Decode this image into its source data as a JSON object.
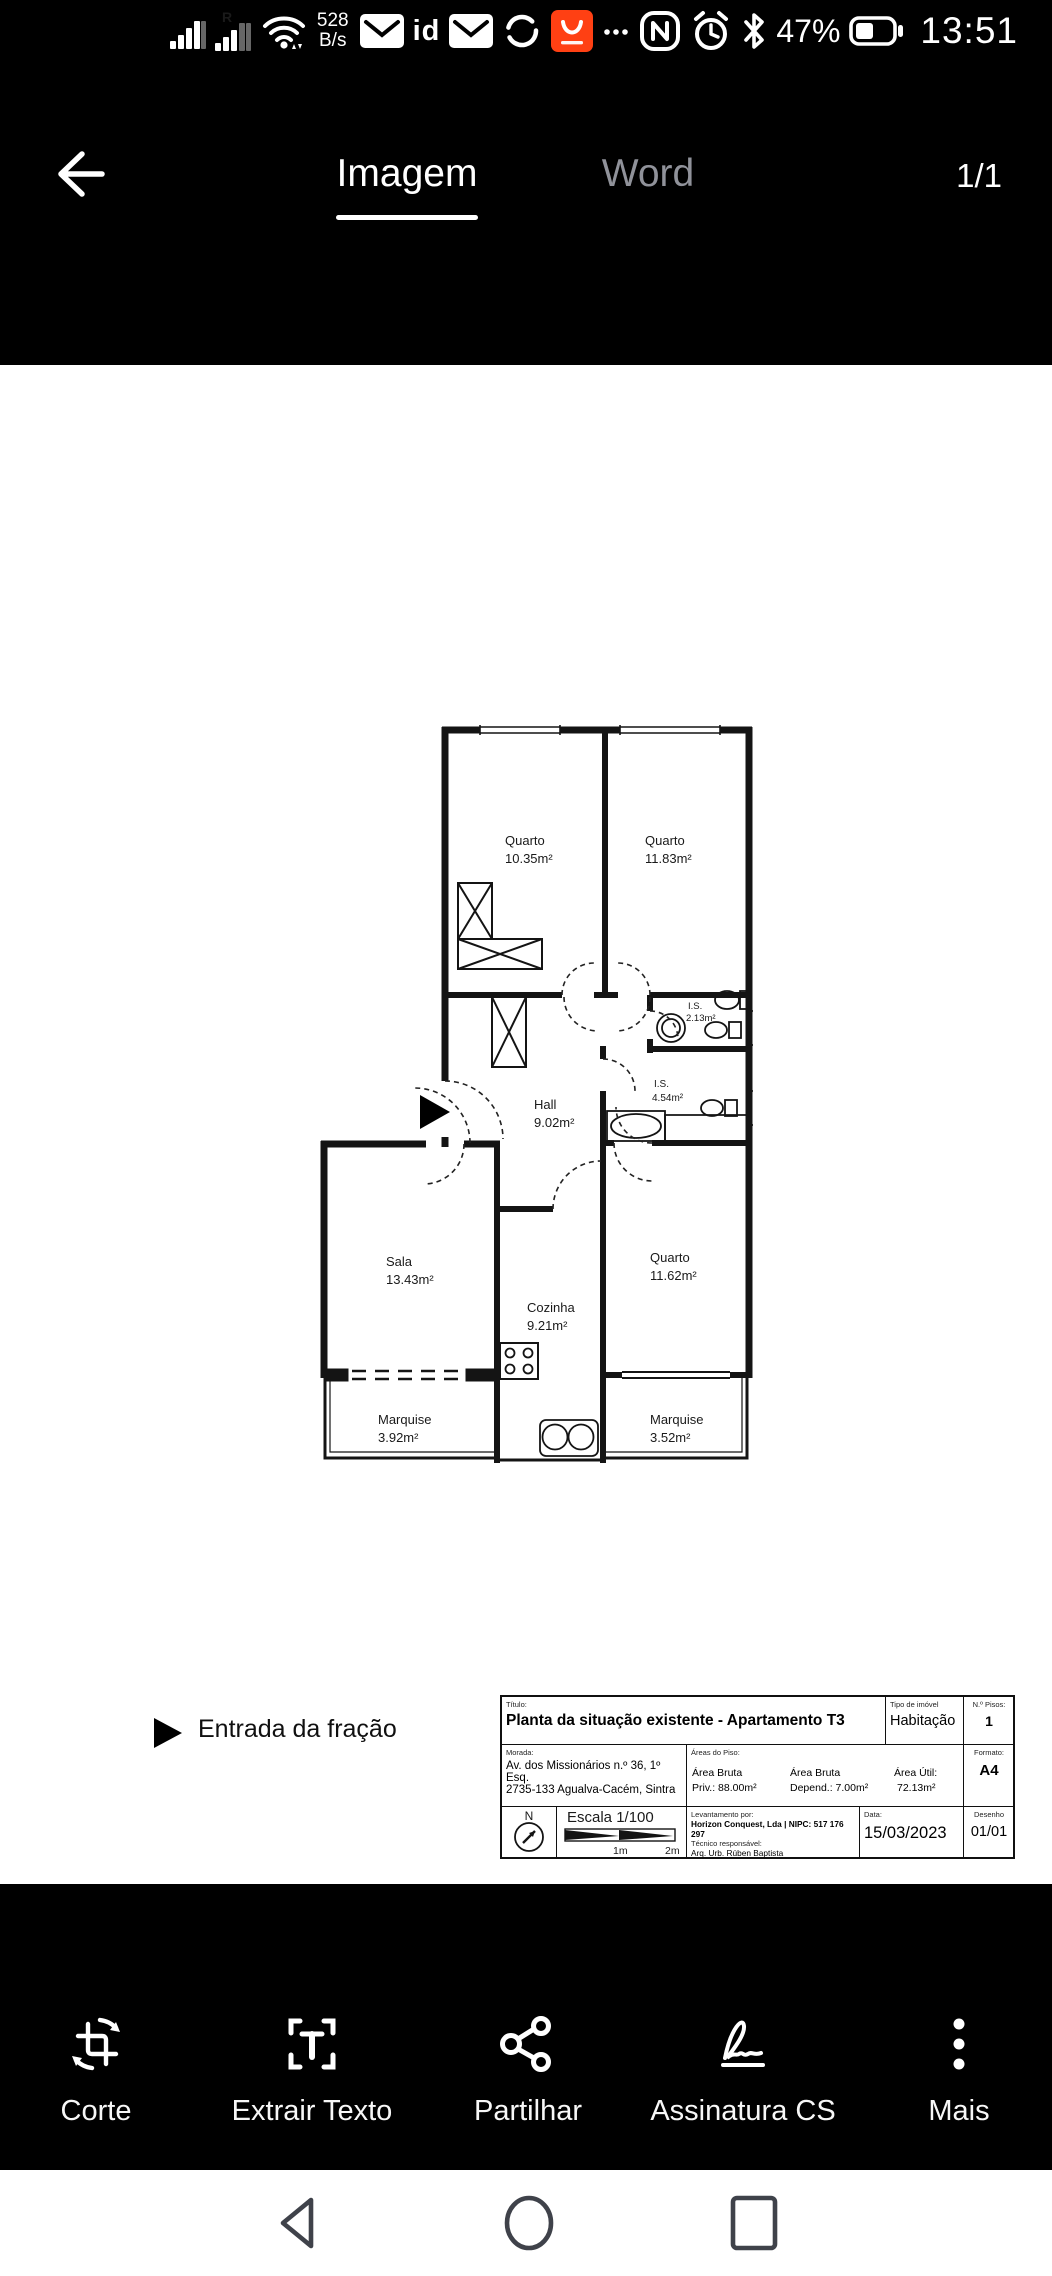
{
  "status_bar": {
    "sim_r_label": "R",
    "net_speed_value": "528",
    "net_speed_unit": "B/s",
    "id_label": "id",
    "battery_percent": "47%",
    "time": "13:51",
    "icons": [
      "signal-icon",
      "signal-r-icon",
      "wifi-icon",
      "mail-icon",
      "id-icon",
      "mail-icon",
      "sync-icon",
      "aliexpress-icon",
      "overflow-dots-icon",
      "nfc-icon",
      "alarm-icon",
      "bluetooth-icon",
      "battery-icon"
    ],
    "accent_red": "#ff4013"
  },
  "header": {
    "tabs": [
      {
        "label": "Imagem",
        "active": true
      },
      {
        "label": "Word",
        "active": false
      }
    ],
    "page_indicator": "1/1"
  },
  "floor_plan": {
    "rooms": [
      {
        "name": "Quarto",
        "area": "10.35m²"
      },
      {
        "name": "Quarto",
        "area": "11.83m²"
      },
      {
        "name": "I.S.",
        "area": "2.13m²"
      },
      {
        "name": "I.S.",
        "area": "4.54m²"
      },
      {
        "name": "Hall",
        "area": "9.02m²"
      },
      {
        "name": "Sala",
        "area": "13.43m²"
      },
      {
        "name": "Cozinha",
        "area": "9.21m²"
      },
      {
        "name": "Quarto",
        "area": "11.62m²"
      },
      {
        "name": "Marquise",
        "area": "3.92m²"
      },
      {
        "name": "Marquise",
        "area": "3.52m²"
      }
    ],
    "entrance_label": "Entrada da fração"
  },
  "title_block": {
    "title_label": "Título:",
    "title": "Planta da situação existente - Apartamento T3",
    "type_label": "Tipo de imóvel",
    "type_value": "Habitação",
    "floors_label": "N.º Pisos:",
    "floors_value": "1",
    "address_label": "Morada:",
    "address_line1": "Av. dos Missionários n.º 36, 1º Esq.",
    "address_line2": "2735-133 Agualva-Cacém, Sintra",
    "areas_label": "Áreas do Piso:",
    "area_gross_label": "Área Bruta",
    "area_gross_value": "Priv.: 88.00m²",
    "area_dep_label": "Área Bruta",
    "area_dep_value": "Depend.: 7.00m²",
    "area_net_label": "Área Útil:",
    "area_net_value": "72.13m²",
    "format_label": "Formato:",
    "format_value": "A4",
    "north_label": "N",
    "scale_label": "Escala 1/100",
    "scale_tick1": "1m",
    "scale_tick2": "2m",
    "survey_label": "Levantamento por:",
    "survey_company": "Horizon Conquest, Lda | NIPC: 517 176 297",
    "tech_label": "Técnico responsável:",
    "tech_name": "Arq. Urb. Rúben Baptista",
    "date_label": "Data:",
    "date_value": "15/03/2023",
    "drawing_label": "Desenho",
    "drawing_value": "01/01"
  },
  "toolbar": {
    "items": [
      {
        "label": "Corte",
        "icon": "crop-icon"
      },
      {
        "label": "Extrair Texto",
        "icon": "extract-text-icon"
      },
      {
        "label": "Partilhar",
        "icon": "share-icon"
      },
      {
        "label": "Assinatura CS",
        "icon": "signature-icon"
      },
      {
        "label": "Mais",
        "icon": "more-icon"
      }
    ]
  },
  "navbar": {
    "items": [
      "back",
      "home",
      "recents"
    ],
    "icon_color": "#3f424a"
  }
}
